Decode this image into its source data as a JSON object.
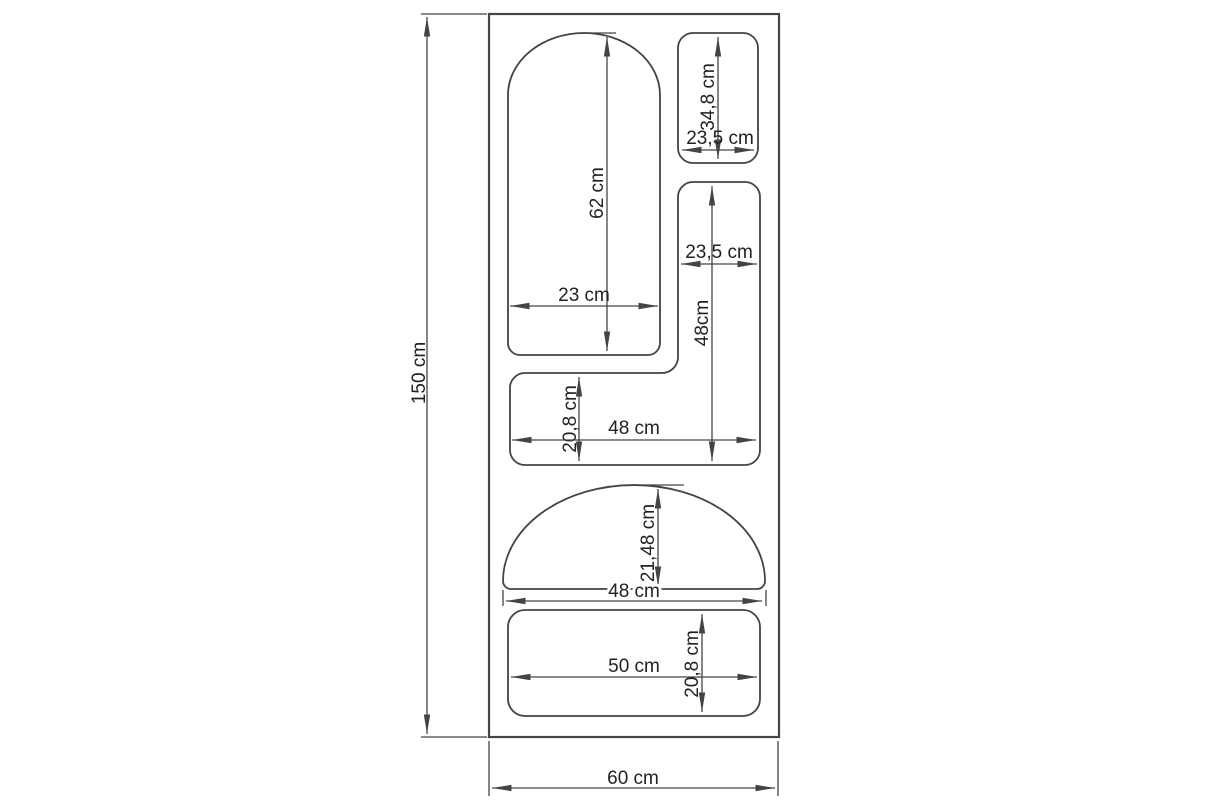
{
  "drawing": {
    "colors": {
      "background": "#ffffff",
      "line": "#444444",
      "text": "#222222"
    },
    "unit": "cm",
    "panel": {
      "height": "150 cm",
      "width": "60 cm"
    },
    "cutouts": {
      "arch": {
        "height": "62 cm",
        "width": "23 cm"
      },
      "top_right_rect": {
        "height": "34,8 cm",
        "width": "23,5 cm"
      },
      "l_shape": {
        "top_width": "23,5 cm",
        "height": "48cm",
        "bar_height": "20,8 cm",
        "bar_width": "48 cm"
      },
      "half_round": {
        "height": "21,48 cm",
        "width": "48 cm"
      },
      "bottom_rect": {
        "width": "50 cm",
        "height": "20,8 cm"
      }
    }
  }
}
